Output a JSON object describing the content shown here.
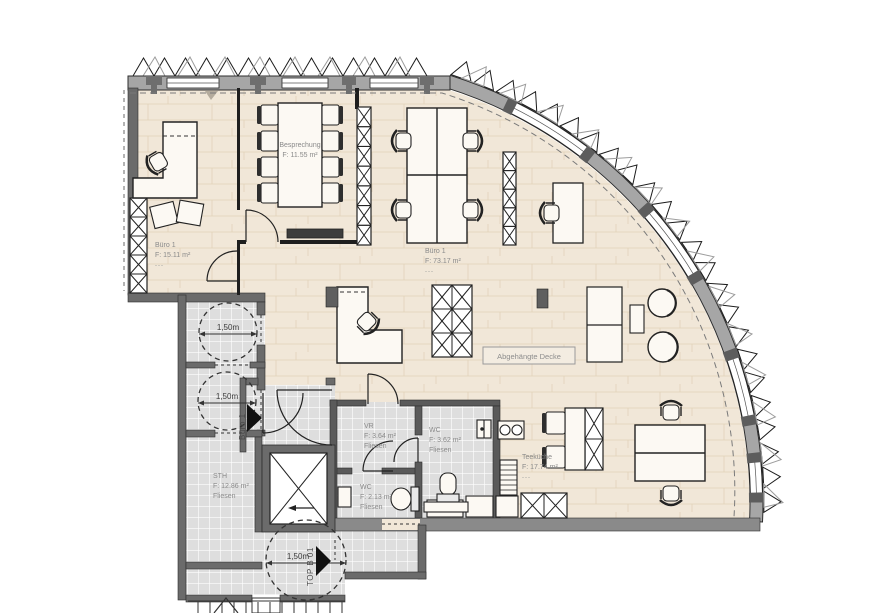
{
  "rooms": {
    "buero1_small": {
      "name": "Büro 1",
      "area": "F: 15.11 m²",
      "note": "---"
    },
    "besprechung": {
      "name": "Besprechung",
      "area": "F: 11.55 m²"
    },
    "buero1_large": {
      "name": "Büro 1",
      "area": "F: 73.17 m²",
      "note": "---"
    },
    "vr": {
      "name": "VR",
      "area": "F: 3.64 m²",
      "floor": "Fliesen"
    },
    "wc_large": {
      "name": "WC",
      "area": "F: 3.62 m²",
      "floor": "Fliesen"
    },
    "wc_small": {
      "name": "WC",
      "area": "F: 2.13 m²",
      "floor": "Fliesen"
    },
    "teekueche": {
      "name": "Teeküche",
      "area": "F: 17.74 m²",
      "note": "---"
    },
    "sth": {
      "name": "STH",
      "area": "F: 12.86 m²",
      "floor": "Fliesen"
    }
  },
  "annotations": {
    "ceiling_label": "Abgehängte Decke",
    "turning_radius_1": "1,50m",
    "turning_radius_2": "1,50m",
    "turning_radius_3": "1,50m",
    "entrance_unit_label": "Büro 1",
    "entrance_top_label": "TOP B 01"
  },
  "colors": {
    "floor_wood": "#f1e7d8",
    "floor_tile": "#dedede",
    "wall_dark": "#6b6b6b",
    "wall_facade": "#a6a6a6",
    "line": "#1e1e1e",
    "label": "#8a8a8a"
  }
}
